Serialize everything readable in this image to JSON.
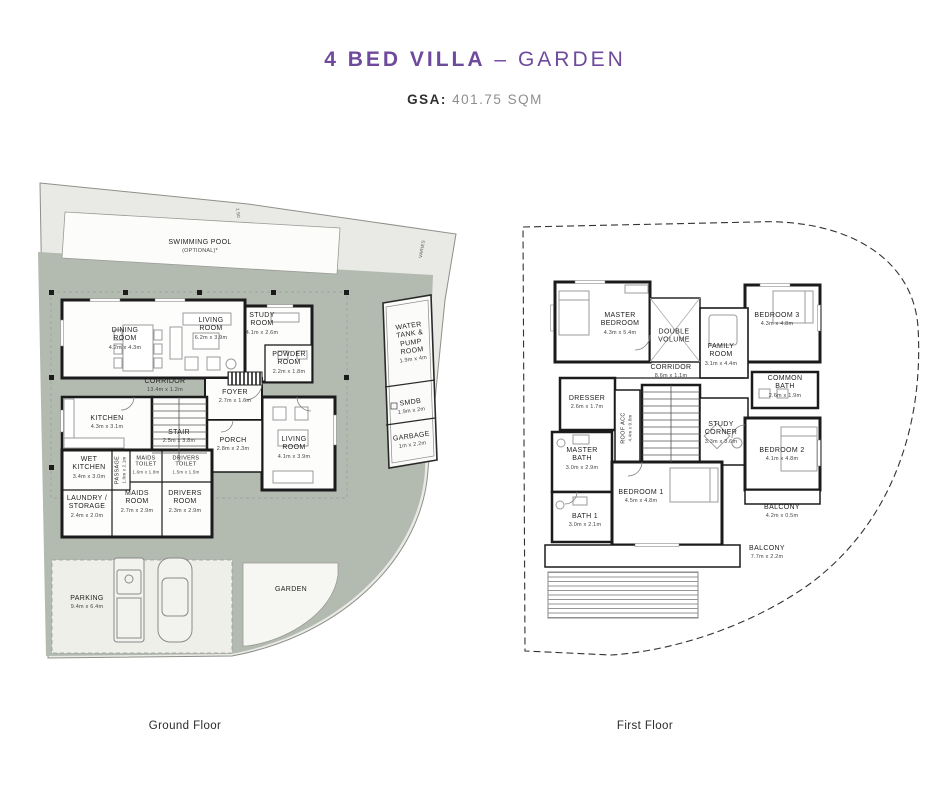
{
  "header": {
    "title": "4 BED VILLA",
    "title_separator": "–",
    "title_variant": "GARDEN",
    "gsa_label": "GSA:",
    "gsa_value": "401.75 SQM"
  },
  "colors": {
    "title_purple": "#6f4a9c",
    "deck_sage": "#b3bab0",
    "plot_gray": "#e9eae5",
    "wall_black": "#1b1b1b"
  },
  "ground_floor": {
    "caption": "Ground Floor",
    "annotations": {
      "pool": "SWIMMING POOL",
      "pool_note": "(OPTIONAL)*",
      "varies": "VARIES",
      "setback": "1.50",
      "garden": "GARDEN"
    },
    "rooms": {
      "dining": {
        "name": "DINING ROOM",
        "dims": "4.2m x 4.3m"
      },
      "living_main": {
        "name": "LIVING ROOM",
        "dims": "6.2m x 3.9m"
      },
      "study": {
        "name": "STUDY ROOM",
        "dims": "4.1m x 2.6m"
      },
      "powder": {
        "name": "POWDER ROOM",
        "dims": "2.2m x 1.8m"
      },
      "corridor": {
        "name": "CORRIDOR",
        "dims": "13.4m x 1.2m"
      },
      "foyer": {
        "name": "FOYER",
        "dims": "2.7m x 1.6m"
      },
      "kitchen": {
        "name": "KITCHEN",
        "dims": "4.3m x 3.1m"
      },
      "stair": {
        "name": "STAIR",
        "dims": "2.5m x 3.8m"
      },
      "porch": {
        "name": "PORCH",
        "dims": "2.8m x 2.3m"
      },
      "living_front": {
        "name": "LIVING ROOM",
        "dims": "4.1m x 3.9m"
      },
      "wet_kitchen": {
        "name": "WET KITCHEN",
        "dims": "3.4m x 3.0m"
      },
      "passage": {
        "name": "PASSAGE",
        "dims": "1.0m x 2.1m"
      },
      "maids_toilet": {
        "name": "MAIDS TOILET",
        "dims": "1.6m x 1.8m"
      },
      "drivers_toilet": {
        "name": "DRIVERS TOILET",
        "dims": "1.5m x 1.5m"
      },
      "laundry": {
        "name": "LAUNDRY / STORAGE",
        "dims": "2.4m x 2.0m"
      },
      "maids_room": {
        "name": "MAIDS ROOM",
        "dims": "2.7m x 2.9m"
      },
      "drivers_room": {
        "name": "DRIVERS ROOM",
        "dims": "2.3m x 2.9m"
      },
      "water_tank": {
        "name": "WATER TANK & PUMP ROOM",
        "dims": "1.9m x 4m"
      },
      "smdb": {
        "name": "SMDB",
        "dims": "1.9m x 2m"
      },
      "garbage": {
        "name": "GARBAGE",
        "dims": "1m x 2.2m"
      },
      "parking": {
        "name": "PARKING",
        "dims": "9.4m x 6.4m"
      }
    }
  },
  "first_floor": {
    "caption": "First Floor",
    "rooms": {
      "master_bedroom": {
        "name": "MASTER BEDROOM",
        "dims": "4.3m x 5.4m"
      },
      "double_volume": {
        "name": "DOUBLE VOLUME",
        "dims": ""
      },
      "family_room": {
        "name": "FAMILY ROOM",
        "dims": "3.1m x 4.4m"
      },
      "bedroom3": {
        "name": "BEDROOM 3",
        "dims": "4.3m x 4.8m"
      },
      "corridor": {
        "name": "CORRIDOR",
        "dims": "8.6m x 1.1m"
      },
      "dresser": {
        "name": "DRESSER",
        "dims": "2.6m x 1.7m"
      },
      "roof_acc": {
        "name": "ROOF ACC",
        "dims": "4.4m x 0.8m"
      },
      "common_bath": {
        "name": "COMMON BATH",
        "dims": "2.6m x 1.9m"
      },
      "study_corner": {
        "name": "STUDY CORNER",
        "dims": "3.3m x 3.6m"
      },
      "master_bath": {
        "name": "MASTER BATH",
        "dims": "3.0m x 2.9m"
      },
      "bedroom2": {
        "name": "BEDROOM 2",
        "dims": "4.1m x 4.8m"
      },
      "bath1": {
        "name": "BATH 1",
        "dims": "3.0m x 2.1m"
      },
      "bedroom1": {
        "name": "BEDROOM 1",
        "dims": "4.5m x 4.8m"
      },
      "balcony_side": {
        "name": "BALCONY",
        "dims": "4.2m x 0.5m"
      },
      "balcony_rear": {
        "name": "BALCONY",
        "dims": "7.7m x 2.2m"
      }
    }
  }
}
